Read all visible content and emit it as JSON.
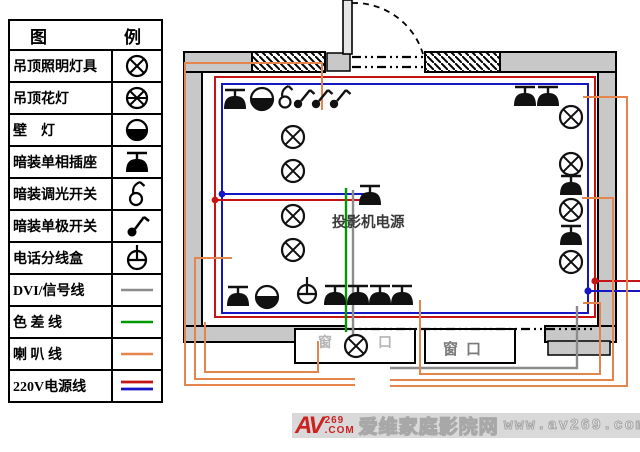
{
  "colors": {
    "power-red": "#c41414",
    "power-blue": "#1616c4",
    "speaker-orange": "#e5854e",
    "component-green": "#009a00",
    "signal-gray": "#8c8c8c",
    "wall-gray": "#c8c8c8",
    "band-gray": "#d9d9d9",
    "logo-red": "#cc2222",
    "watermark-gray": "#a8a8a8",
    "window-text-gray": "#7a7a7a",
    "window-text-light": "#b5b5b5",
    "projector-label": "#3a3a3a"
  },
  "legend": {
    "title_left": "图",
    "title_right": "例",
    "rows": [
      {
        "label": "吊顶照明灯具",
        "symbol": "ceiling-lamp"
      },
      {
        "label": "吊顶花灯",
        "symbol": "chandelier"
      },
      {
        "label": "壁    灯",
        "symbol": "wall-lamp"
      },
      {
        "label": "暗装单相插座",
        "symbol": "flush-single-phase-socket"
      },
      {
        "label": "暗装调光开关",
        "symbol": "flush-dimmer-switch"
      },
      {
        "label": "暗装单极开关",
        "symbol": "flush-single-pole-switch"
      },
      {
        "label": "电话分线盒",
        "symbol": "telephone-junction-box"
      },
      {
        "label": "DVI/信号线",
        "symbol": "dvi-signal-line"
      },
      {
        "label": "色 差 线",
        "symbol": "component-video-line"
      },
      {
        "label": "喇 叭 线",
        "symbol": "speaker-line"
      },
      {
        "label": "220V电源线",
        "symbol": "220v-power-line"
      }
    ]
  },
  "diagram": {
    "projector_power_label": "投影机电源",
    "left_window": {
      "char_left": "窗",
      "char_right": "口"
    },
    "right_window_label": "窗口"
  },
  "watermark": {
    "logo_av": "AV",
    "logo_num": "269",
    "logo_com": ".COM",
    "site_name": "爱维家庭影院网",
    "site_url": "www.av269.com"
  }
}
